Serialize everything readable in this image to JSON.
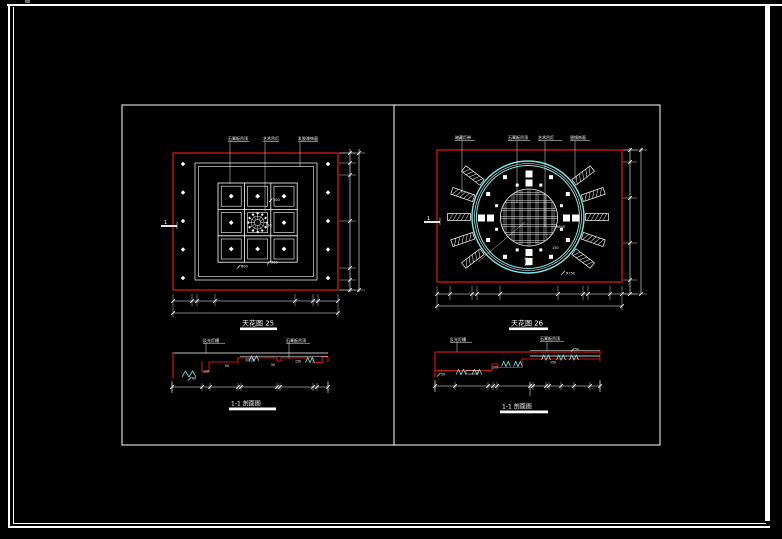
{
  "colors": {
    "background": "#000000",
    "line_white": "#ffffff",
    "accent_red": "#c41414",
    "accent_cyan": "#7fe6e6"
  },
  "left_plan": {
    "title": "天花图 25",
    "callouts": [
      "石膏板吊顶",
      "艺术吊灯",
      "乳胶漆饰面"
    ],
    "section_marker": "1",
    "dims": [
      "500",
      "150",
      "300",
      "600"
    ]
  },
  "right_plan": {
    "title": "天花图 26",
    "callouts": [
      "暗藏灯带",
      "石膏板吊顶",
      "艺术吊灯",
      "银镜饰面"
    ],
    "section_marker": "1",
    "dims": [
      "R600",
      "150",
      "300",
      "150",
      "R750"
    ]
  },
  "left_section": {
    "title": "1-1 剖面图",
    "callouts": [
      "反光灯槽",
      "石膏板吊顶"
    ],
    "dims": [
      "60",
      "100",
      "50",
      "50",
      "150"
    ]
  },
  "right_section": {
    "title": "1-1 剖面图",
    "callouts": [
      "反光灯槽",
      "石膏板吊顶"
    ],
    "dims": [
      "50",
      "100",
      "150",
      "50"
    ]
  }
}
